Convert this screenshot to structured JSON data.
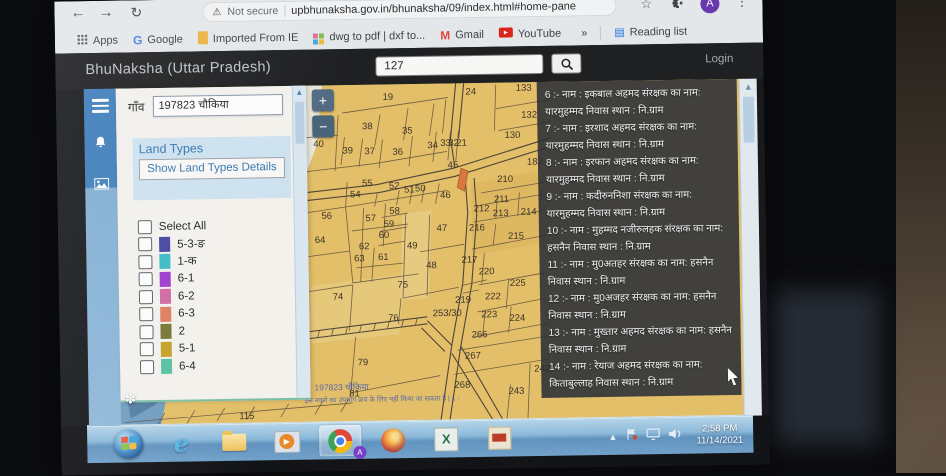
{
  "browser": {
    "security_label": "Not secure",
    "url": "upbhunaksha.gov.in/bhunaksha/09/index.html#home-pane",
    "profile_initial": "A",
    "bookmarks": [
      {
        "label": "Apps",
        "icon": "apps-grid"
      },
      {
        "label": "Google",
        "icon": "google-g"
      },
      {
        "label": "Imported From IE",
        "icon": "ie-folder"
      },
      {
        "label": "dwg to pdf | dxf to...",
        "icon": "dwg"
      },
      {
        "label": "Gmail",
        "icon": "gmail-m"
      },
      {
        "label": "YouTube",
        "icon": "youtube"
      },
      {
        "label": "»",
        "icon": "none"
      },
      {
        "label": "Reading list",
        "icon": "reading-list"
      }
    ]
  },
  "header": {
    "title": "BhuNaksha (Uttar Pradesh)",
    "search_value": "127",
    "login_label": "Login"
  },
  "sidebar": {
    "village_label": "गाँव",
    "village_value": "197823 चौकिया",
    "land_types_title": "Land Types",
    "show_details_button": "Show Land Types Details",
    "select_all_label": "Select All",
    "legend": [
      {
        "label": "5-3-ङ",
        "color": "#4343a5"
      },
      {
        "label": "1-क",
        "color": "#35bec9"
      },
      {
        "label": "6-1",
        "color": "#a238d8"
      },
      {
        "label": "6-2",
        "color": "#d468a6"
      },
      {
        "label": "6-3",
        "color": "#e57d5c"
      },
      {
        "label": "2",
        "color": "#76762f"
      },
      {
        "label": "5-1",
        "color": "#c9a21f"
      },
      {
        "label": "6-4",
        "color": "#52c4a2"
      }
    ]
  },
  "map": {
    "zoom_in": "+",
    "zoom_out": "−",
    "highlight_color": "#e0763a",
    "village_stamp": "197823 चौकिया",
    "disclaimer": "इस नक्शे का उपयोग क्रय के लिए नहीं किया जा सकता है | 1 :",
    "plots": [
      {
        "n": "19",
        "x": 274,
        "y": 13
      },
      {
        "n": "24",
        "x": 357,
        "y": 9
      },
      {
        "n": "133",
        "x": 410,
        "y": 6
      },
      {
        "n": "132",
        "x": 415,
        "y": 33
      },
      {
        "n": "130",
        "x": 398,
        "y": 53
      },
      {
        "n": "38",
        "x": 253,
        "y": 42
      },
      {
        "n": "35",
        "x": 293,
        "y": 47
      },
      {
        "n": "40",
        "x": 204,
        "y": 59
      },
      {
        "n": "39",
        "x": 233,
        "y": 66
      },
      {
        "n": "37",
        "x": 255,
        "y": 67
      },
      {
        "n": "36",
        "x": 283,
        "y": 68
      },
      {
        "n": "34",
        "x": 318,
        "y": 62
      },
      {
        "n": "33",
        "x": 331,
        "y": 60
      },
      {
        "n": "32",
        "x": 339,
        "y": 60
      },
      {
        "n": "21",
        "x": 347,
        "y": 60
      },
      {
        "n": "45",
        "x": 338,
        "y": 82
      },
      {
        "n": "210",
        "x": 390,
        "y": 97
      },
      {
        "n": "182",
        "x": 420,
        "y": 80
      },
      {
        "n": "55",
        "x": 252,
        "y": 99
      },
      {
        "n": "52",
        "x": 279,
        "y": 102
      },
      {
        "n": "51",
        "x": 294,
        "y": 106
      },
      {
        "n": "50",
        "x": 305,
        "y": 105
      },
      {
        "n": "54",
        "x": 240,
        "y": 110
      },
      {
        "n": "46",
        "x": 330,
        "y": 112
      },
      {
        "n": "56",
        "x": 211,
        "y": 131
      },
      {
        "n": "57",
        "x": 255,
        "y": 134
      },
      {
        "n": "58",
        "x": 279,
        "y": 127
      },
      {
        "n": "59",
        "x": 273,
        "y": 140
      },
      {
        "n": "60",
        "x": 268,
        "y": 151
      },
      {
        "n": "62",
        "x": 248,
        "y": 162
      },
      {
        "n": "61",
        "x": 267,
        "y": 173
      },
      {
        "n": "63",
        "x": 243,
        "y": 174
      },
      {
        "n": "64",
        "x": 204,
        "y": 155
      },
      {
        "n": "49",
        "x": 296,
        "y": 162
      },
      {
        "n": "47",
        "x": 326,
        "y": 145
      },
      {
        "n": "48",
        "x": 315,
        "y": 182
      },
      {
        "n": "74",
        "x": 221,
        "y": 212
      },
      {
        "n": "75",
        "x": 286,
        "y": 201
      },
      {
        "n": "211",
        "x": 386,
        "y": 117
      },
      {
        "n": "212",
        "x": 366,
        "y": 126
      },
      {
        "n": "213",
        "x": 385,
        "y": 131
      },
      {
        "n": "214",
        "x": 413,
        "y": 130
      },
      {
        "n": "216",
        "x": 361,
        "y": 145
      },
      {
        "n": "215",
        "x": 400,
        "y": 154
      },
      {
        "n": "217",
        "x": 353,
        "y": 177
      },
      {
        "n": "220",
        "x": 370,
        "y": 189
      },
      {
        "n": "225",
        "x": 401,
        "y": 201
      },
      {
        "n": "222",
        "x": 376,
        "y": 214
      },
      {
        "n": "219",
        "x": 346,
        "y": 217
      },
      {
        "n": "76",
        "x": 276,
        "y": 234
      },
      {
        "n": "79",
        "x": 245,
        "y": 278
      },
      {
        "n": "81",
        "x": 236,
        "y": 309
      },
      {
        "n": "223",
        "x": 372,
        "y": 232
      },
      {
        "n": "224",
        "x": 400,
        "y": 236
      },
      {
        "n": "266",
        "x": 362,
        "y": 252
      },
      {
        "n": "267",
        "x": 355,
        "y": 273
      },
      {
        "n": "268",
        "x": 344,
        "y": 302
      },
      {
        "n": "242",
        "x": 424,
        "y": 287
      },
      {
        "n": "243",
        "x": 398,
        "y": 309
      },
      {
        "n": "253/30",
        "x": 330,
        "y": 230
      },
      {
        "n": "115",
        "x": 128,
        "y": 330
      }
    ]
  },
  "records": {
    "items": [
      "6 :- नाम : इकबाल अहमद संरक्षक का नाम: यारमुहम्मद निवास स्थान : नि.ग्राम",
      "7 :- नाम : इरशाद अहमद संरक्षक का नाम: यारमुहम्मद निवास स्थान : नि.ग्राम",
      "8 :- नाम : इरफान अहमद संरक्षक का नाम: यारमुहम्मद निवास स्थान : नि.ग्राम",
      "9 :- नाम : कदीरुननिशा संरक्षक का नाम: यारमुहम्मद निवास स्थान : नि.ग्राम",
      "10 :- नाम : मुहम्मद नजीरुलहक संरक्षक का नाम: हसनैन निवास स्थान : नि.ग्राम",
      "11 :- नाम : मु0अतहर संरक्षक का नाम: हसनैन निवास स्थान : नि.ग्राम",
      "12 :- नाम : मु0अजहर संरक्षक का नाम: हसनैन निवास स्थान : नि.ग्राम",
      "13 :- नाम : मुख्तार अहमद संरक्षक का नाम: हसनैन निवास स्थान : नि.ग्राम",
      "14 :- नाम : रेयाज अहमद संरक्षक का नाम: किताबुल्लाह निवास स्थान : नि.ग्राम"
    ]
  },
  "taskbar": {
    "time": "2:58 PM",
    "date": "11/14/2021",
    "apps": [
      {
        "name": "start"
      },
      {
        "name": "internet-explorer"
      },
      {
        "name": "file-explorer"
      },
      {
        "name": "media-player"
      },
      {
        "name": "chrome",
        "active": true
      },
      {
        "name": "firefox"
      },
      {
        "name": "excel"
      },
      {
        "name": "cad-viewer"
      }
    ]
  }
}
